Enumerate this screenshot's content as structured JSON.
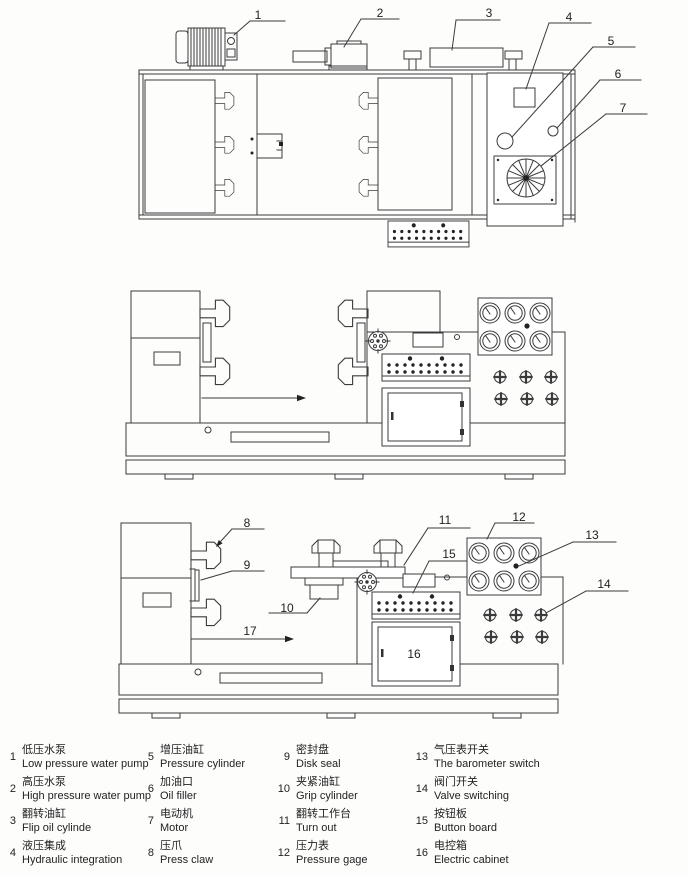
{
  "callouts": {
    "c1": "1",
    "c2": "2",
    "c3": "3",
    "c4": "4",
    "c5": "5",
    "c6": "6",
    "c7": "7",
    "c8": "8",
    "c9": "9",
    "c10": "10",
    "c11": "11",
    "c12": "12",
    "c13": "13",
    "c14": "14",
    "c15": "15",
    "c16": "16",
    "c17": "17"
  },
  "legend": {
    "items": [
      {
        "num": "1",
        "zh": "低压水泵",
        "en": "Low pressure water pump"
      },
      {
        "num": "2",
        "zh": "高压水泵",
        "en": "High pressure water pump"
      },
      {
        "num": "3",
        "zh": "翻转油缸",
        "en": "Flip oil cylinde"
      },
      {
        "num": "4",
        "zh": "液压集成",
        "en": "Hydraulic integration"
      },
      {
        "num": "5",
        "zh": "增压油缸",
        "en": "Pressure cylinder"
      },
      {
        "num": "6",
        "zh": "加油口",
        "en": "Oil filler"
      },
      {
        "num": "7",
        "zh": "电动机",
        "en": "Motor"
      },
      {
        "num": "8",
        "zh": "压爪",
        "en": "Press claw"
      },
      {
        "num": "9",
        "zh": "密封盘",
        "en": "Disk seal"
      },
      {
        "num": "10",
        "zh": "夹紧油缸",
        "en": "Grip cylinder"
      },
      {
        "num": "11",
        "zh": "翻转工作台",
        "en": "Turn out"
      },
      {
        "num": "12",
        "zh": "压力表",
        "en": "Pressure gage"
      },
      {
        "num": "13",
        "zh": "气压表开关",
        "en": "The barometer switch"
      },
      {
        "num": "14",
        "zh": "阀门开关",
        "en": "Valve switching"
      },
      {
        "num": "15",
        "zh": "按钮板",
        "en": "Button board"
      },
      {
        "num": "16",
        "zh": "电控箱",
        "en": "Electric cabinet"
      }
    ]
  }
}
